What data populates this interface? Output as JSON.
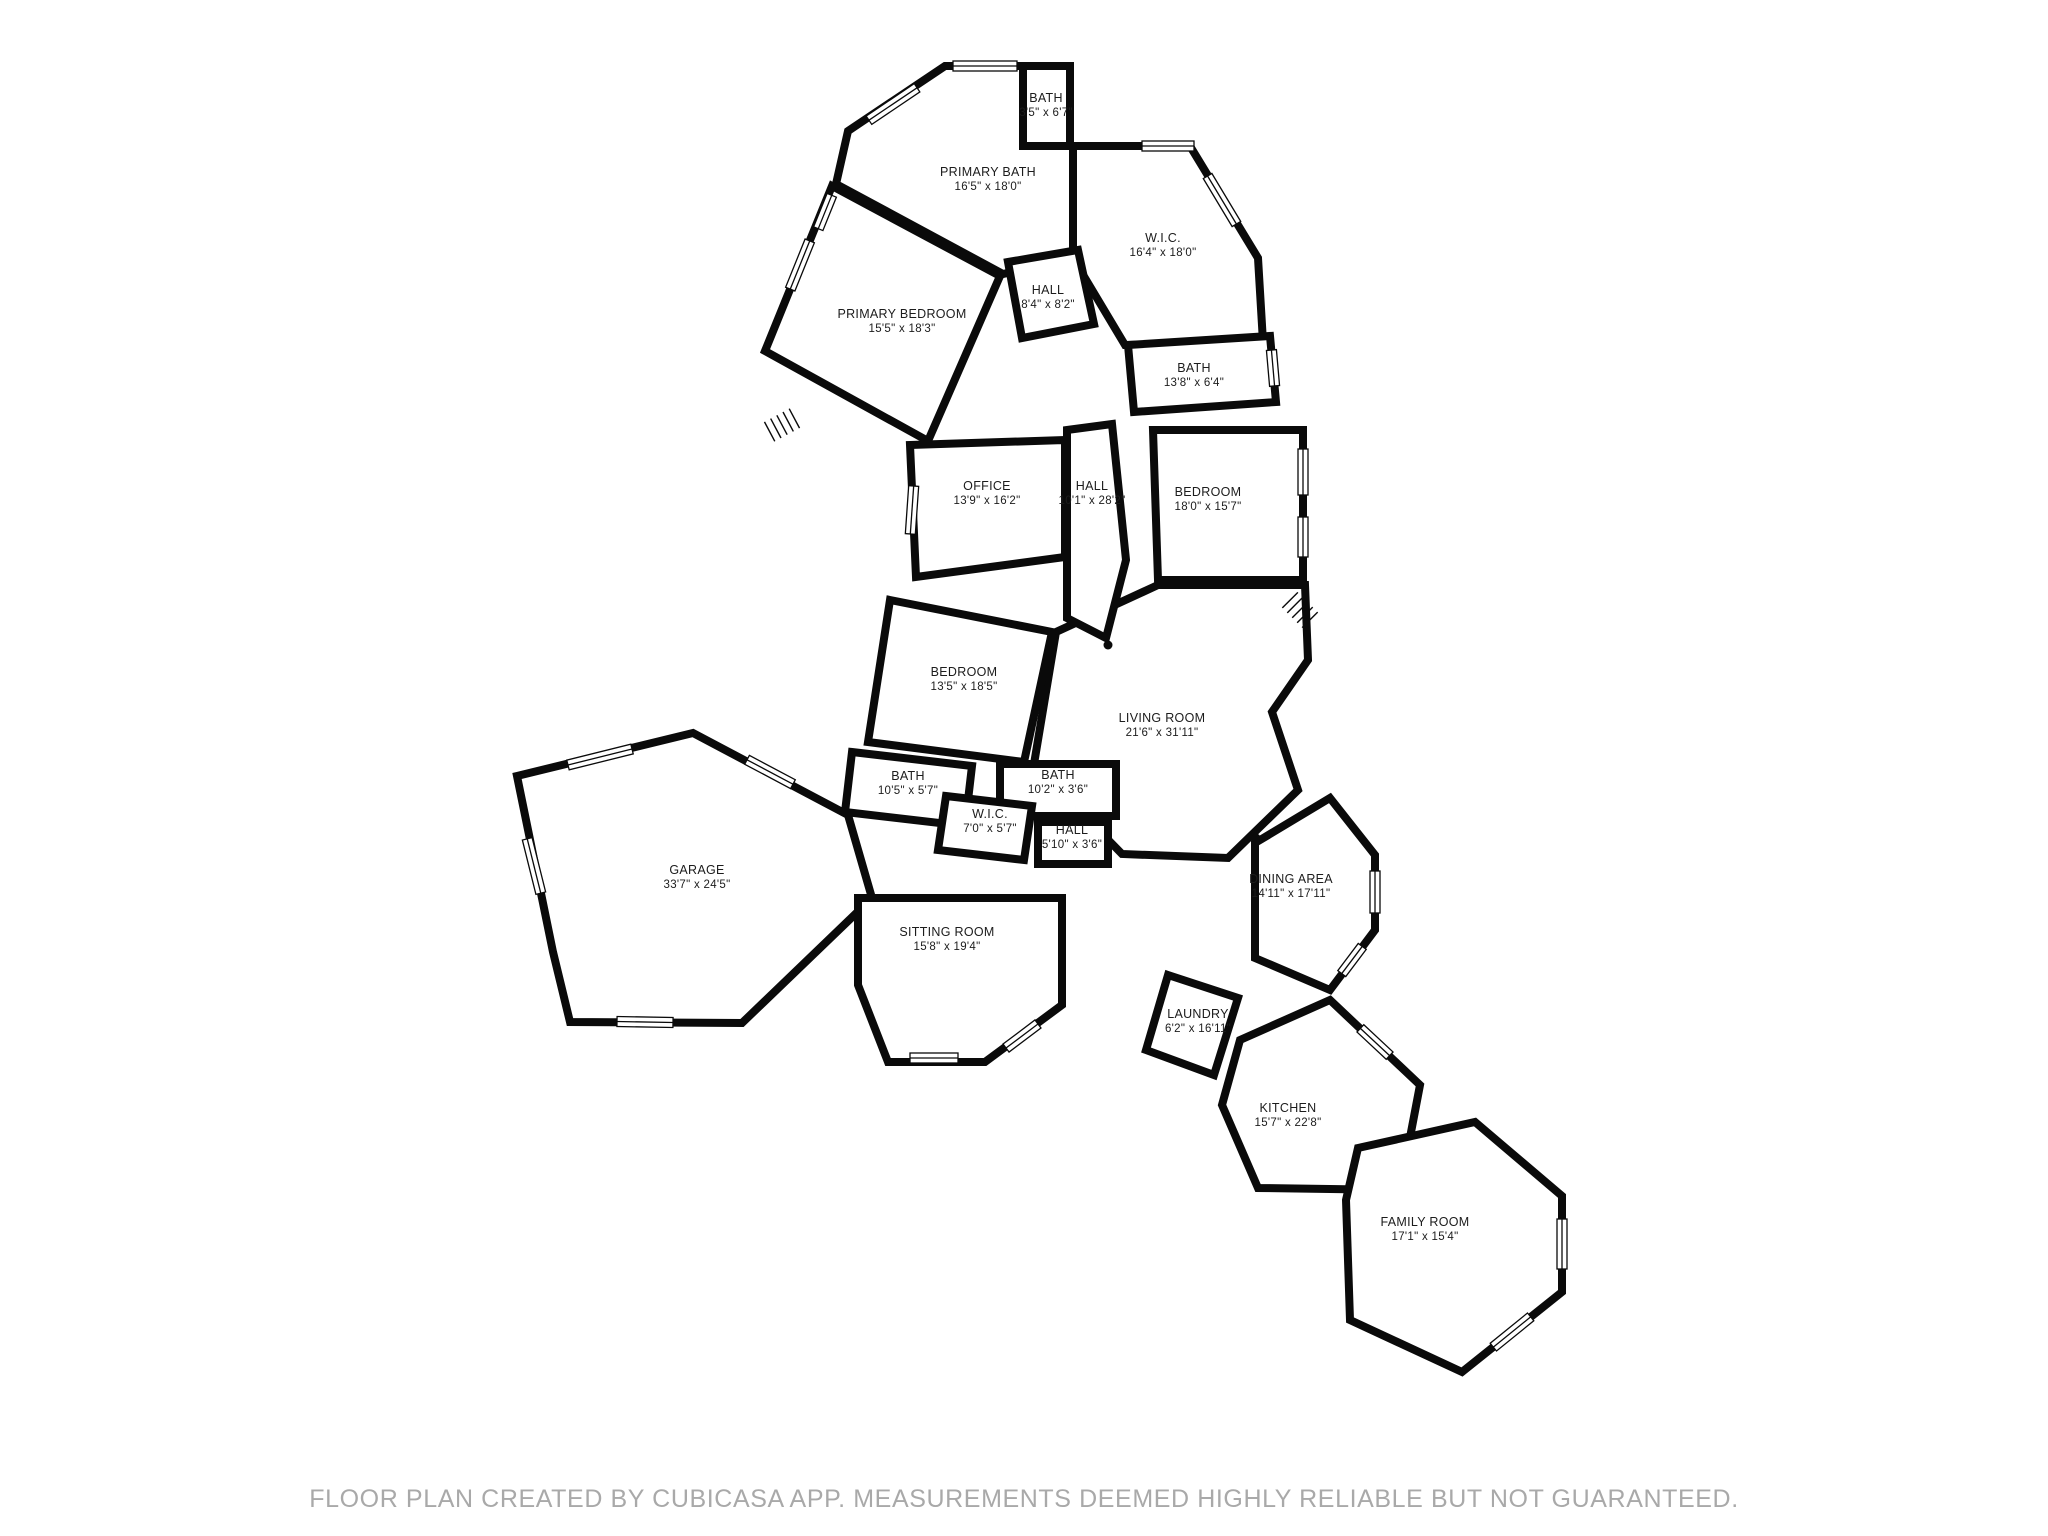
{
  "footer": {
    "text": "FLOOR PLAN CREATED BY CUBICASA APP. MEASUREMENTS DEEMED HIGHLY RELIABLE BUT NOT GUARANTEED.",
    "color": "#a9a9a9"
  },
  "plan": {
    "wall_color": "#0a0a0a",
    "wall_width": 8,
    "background": "#ffffff",
    "rooms": [
      {
        "id": "garage",
        "name": "GARAGE",
        "dims": "33'7\" x 24'5\"",
        "label_x": 697,
        "label_y": 874,
        "points": "517,776 693,733 848,815 872,898 742,1023 570,1022 553,952"
      },
      {
        "id": "sitting-room",
        "name": "SITTING ROOM",
        "dims": "15'8\" x 19'4\"",
        "label_x": 947,
        "label_y": 936,
        "points": "858,898 1062,898 1062,1005 985,1062 888,1062 858,985"
      },
      {
        "id": "living-room",
        "name": "LIVING ROOM",
        "dims": "21'6\" x 31'11\"",
        "label_x": 1162,
        "label_y": 722,
        "points": "1158,585 1305,585 1308,660 1272,712 1298,790 1228,858 1122,854 1034,764 1056,632"
      },
      {
        "id": "dining-area",
        "name": "DINING AREA",
        "dims": "14'11\" x 17'11\"",
        "label_x": 1291,
        "label_y": 883,
        "points": "1255,843 1330,798 1375,855 1375,930 1330,990 1255,958"
      },
      {
        "id": "kitchen",
        "name": "KITCHEN",
        "dims": "15'7\" x 22'8\"",
        "label_x": 1288,
        "label_y": 1112,
        "points": "1240,1040 1330,1000 1420,1085 1400,1190 1258,1188 1222,1105"
      },
      {
        "id": "family-room",
        "name": "FAMILY ROOM",
        "dims": "17'1\" x 15'4\"",
        "label_x": 1425,
        "label_y": 1226,
        "points": "1358,1148 1475,1122 1562,1196 1562,1292 1462,1372 1350,1320 1346,1200"
      },
      {
        "id": "laundry",
        "name": "LAUNDRY",
        "dims": "6'2\" x 16'11\"",
        "label_x": 1198,
        "label_y": 1018,
        "points": "1168,975 1238,998 1214,1075 1146,1050"
      },
      {
        "id": "primary-bedroom",
        "name": "PRIMARY BEDROOM",
        "dims": "15'5\" x 18'3\"",
        "label_x": 902,
        "label_y": 318,
        "points": "832,186 1000,276 928,441 765,351"
      },
      {
        "id": "primary-bath",
        "name": "PRIMARY BATH",
        "dims": "16'5\" x 18'0\"",
        "label_x": 988,
        "label_y": 176,
        "points": "945,66 1023,66 1023,146 1073,146 1073,258 1003,274 836,184 848,131"
      },
      {
        "id": "bath-top",
        "name": "BATH",
        "dims": "3'5\" x 6'7\"",
        "label_x": 1046,
        "label_y": 102,
        "points": "1023,66 1070,66 1070,146 1023,146"
      },
      {
        "id": "wic-upper",
        "name": "W.I.C.",
        "dims": "16'4\" x 18'0\"",
        "label_x": 1163,
        "label_y": 242,
        "points": "1073,146 1190,146 1258,258 1263,342 1125,345 1073,258"
      },
      {
        "id": "hall-upper",
        "name": "HALL",
        "dims": "8'4\" x 8'2\"",
        "label_x": 1048,
        "label_y": 294,
        "points": "1008,262 1078,250 1094,324 1022,338"
      },
      {
        "id": "bath-13-8",
        "name": "BATH",
        "dims": "13'8\" x 6'4\"",
        "label_x": 1194,
        "label_y": 372,
        "points": "1128,345 1270,336 1276,402 1134,412"
      },
      {
        "id": "office",
        "name": "OFFICE",
        "dims": "13'9\" x 16'2\"",
        "label_x": 987,
        "label_y": 490,
        "points": "910,445 1065,440 1065,557 916,577"
      },
      {
        "id": "hall-long",
        "name": "HALL",
        "dims": "10'1\" x 28'2\"",
        "label_x": 1092,
        "label_y": 490,
        "points": "1067,430 1112,424 1126,560 1106,638 1067,618"
      },
      {
        "id": "bedroom-18-0",
        "name": "BEDROOM",
        "dims": "18'0\" x 15'7\"",
        "label_x": 1208,
        "label_y": 496,
        "points": "1153,430 1303,430 1303,580 1158,580"
      },
      {
        "id": "bedroom-13-5",
        "name": "BEDROOM",
        "dims": "13'5\" x 18'5\"",
        "label_x": 964,
        "label_y": 676,
        "points": "890,600 1052,632 1024,762 868,742"
      },
      {
        "id": "bath-10-5",
        "name": "BATH",
        "dims": "10'5\" x 5'7\"",
        "label_x": 908,
        "label_y": 780,
        "points": "852,752 972,766 965,826 845,812"
      },
      {
        "id": "bath-10-2",
        "name": "BATH",
        "dims": "10'2\" x 3'6\"",
        "label_x": 1058,
        "label_y": 779,
        "points": "1000,764 1116,764 1116,816 1000,816"
      },
      {
        "id": "wic-7-0",
        "name": "W.I.C.",
        "dims": "7'0\" x 5'7\"",
        "label_x": 990,
        "label_y": 818,
        "points": "946,796 1032,806 1024,860 938,850"
      },
      {
        "id": "hall-5-10",
        "name": "HALL",
        "dims": "5'10\" x 3'6\"",
        "label_x": 1072,
        "label_y": 834,
        "points": "1038,822 1108,822 1108,864 1038,864"
      }
    ],
    "windows": [
      {
        "x": 985,
        "y": 66,
        "len": 64,
        "angle": 0
      },
      {
        "x": 893,
        "y": 104,
        "len": 58,
        "angle": -34
      },
      {
        "x": 800,
        "y": 265,
        "len": 52,
        "angle": -68
      },
      {
        "x": 825,
        "y": 212,
        "len": 36,
        "angle": -68
      },
      {
        "x": 1222,
        "y": 200,
        "len": 56,
        "angle": 59
      },
      {
        "x": 1168,
        "y": 146,
        "len": 52,
        "angle": 0
      },
      {
        "x": 1303,
        "y": 472,
        "len": 46,
        "angle": 90
      },
      {
        "x": 1303,
        "y": 537,
        "len": 40,
        "angle": 90
      },
      {
        "x": 912,
        "y": 510,
        "len": 48,
        "angle": 94
      },
      {
        "x": 1273,
        "y": 368,
        "len": 36,
        "angle": 85
      },
      {
        "x": 770,
        "y": 772,
        "len": 52,
        "angle": 28
      },
      {
        "x": 600,
        "y": 757,
        "len": 66,
        "angle": -14
      },
      {
        "x": 534,
        "y": 866,
        "len": 56,
        "angle": 76
      },
      {
        "x": 645,
        "y": 1022,
        "len": 56,
        "angle": 1
      },
      {
        "x": 934,
        "y": 1058,
        "len": 48,
        "angle": 0
      },
      {
        "x": 1022,
        "y": 1036,
        "len": 40,
        "angle": -37
      },
      {
        "x": 1375,
        "y": 892,
        "len": 42,
        "angle": 90
      },
      {
        "x": 1352,
        "y": 960,
        "len": 34,
        "angle": -53
      },
      {
        "x": 1375,
        "y": 1042,
        "len": 40,
        "angle": 43
      },
      {
        "x": 1562,
        "y": 1244,
        "len": 50,
        "angle": 90
      },
      {
        "x": 1512,
        "y": 1332,
        "len": 48,
        "angle": -39
      }
    ],
    "dots": [
      {
        "x": 1108,
        "y": 645
      },
      {
        "x": 1256,
        "y": 838
      }
    ],
    "stairs": [
      {
        "x": 782,
        "y": 425,
        "angle": -28
      },
      {
        "x": 1300,
        "y": 610,
        "angle": 45
      }
    ]
  }
}
